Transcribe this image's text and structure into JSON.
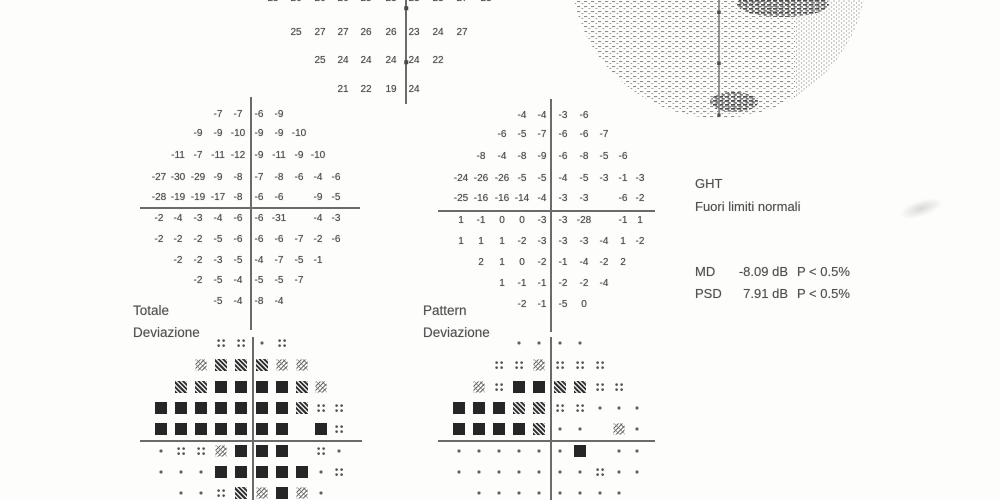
{
  "labels": {
    "total_plot_line1": "Totale",
    "total_plot_line2": "Deviazione",
    "pattern_plot_line1": "Pattern",
    "pattern_plot_line2": "Deviazione"
  },
  "summary": {
    "ght_title": "GHT",
    "ght_result": "Fuori limiti normali",
    "md_label": "MD",
    "md_value": "-8.09 dB",
    "md_p": "P < 0.5%",
    "psd_label": "PSD",
    "psd_value": "7.91 dB",
    "psd_p": "P < 0.5%"
  },
  "grids": [
    {
      "name": "threshold-grid",
      "kind": "numeric",
      "cols": [
        273,
        296,
        320,
        343,
        366,
        391,
        414,
        438,
        462,
        486
      ],
      "rows_y": [
        -1,
        33,
        61,
        90
      ],
      "rows": [
        [
          "25",
          "26",
          "26",
          "26",
          "25",
          "23",
          "23",
          "23",
          "27",
          "23"
        ],
        [
          "",
          "25",
          "27",
          "27",
          "26",
          "26",
          "23",
          "24",
          "27",
          ""
        ],
        [
          "",
          "",
          "25",
          "24",
          "24",
          "24",
          "24",
          "22",
          "",
          ""
        ],
        [
          "",
          "",
          "",
          "21",
          "22",
          "19",
          "24",
          "",
          "",
          ""
        ]
      ]
    },
    {
      "name": "total-deviation-grid",
      "kind": "numeric",
      "cols": [
        159,
        178,
        198,
        218,
        238,
        259,
        279,
        299,
        318,
        336
      ],
      "rows_y": [
        115,
        134,
        156,
        178,
        198,
        219,
        240,
        261,
        281,
        302
      ],
      "rows": [
        [
          "",
          "",
          "",
          "-7",
          "-7",
          "-6",
          "-9",
          "",
          "",
          ""
        ],
        [
          "",
          "",
          "-9",
          "-9",
          "-10",
          "-9",
          "-9",
          "-10",
          "",
          ""
        ],
        [
          "",
          "-11",
          "-7",
          "-11",
          "-12",
          "-9",
          "-11",
          "-9",
          "-10",
          ""
        ],
        [
          "-27",
          "-30",
          "-29",
          "-9",
          "-8",
          "-7",
          "-8",
          "-6",
          "-4",
          "-6"
        ],
        [
          "-28",
          "-19",
          "-19",
          "-17",
          "-8",
          "-6",
          "-6",
          "",
          "-9",
          "-5"
        ],
        [
          "-2",
          "-4",
          "-3",
          "-4",
          "-6",
          "-6",
          "-31",
          "",
          "-4",
          "-3"
        ],
        [
          "-2",
          "-2",
          "-2",
          "-5",
          "-6",
          "-6",
          "-6",
          "-7",
          "-2",
          "-6"
        ],
        [
          "",
          "-2",
          "-2",
          "-3",
          "-5",
          "-4",
          "-7",
          "-5",
          "-1",
          ""
        ],
        [
          "",
          "",
          "-2",
          "-5",
          "-4",
          "-5",
          "-5",
          "-7",
          "",
          ""
        ],
        [
          "",
          "",
          "",
          "-5",
          "-4",
          "-8",
          "-4",
          "",
          "",
          ""
        ]
      ]
    },
    {
      "name": "pattern-deviation-grid",
      "kind": "numeric",
      "cols": [
        461,
        481,
        502,
        522,
        542,
        563,
        584,
        604,
        623,
        640
      ],
      "rows_y": [
        116,
        135,
        157,
        179,
        199,
        221,
        242,
        263,
        284,
        305
      ],
      "rows": [
        [
          "",
          "",
          "",
          "-4",
          "-4",
          "-3",
          "-6",
          "",
          "",
          ""
        ],
        [
          "",
          "",
          "-6",
          "-5",
          "-7",
          "-6",
          "-6",
          "-7",
          "",
          ""
        ],
        [
          "",
          "-8",
          "-4",
          "-8",
          "-9",
          "-6",
          "-8",
          "-5",
          "-6",
          ""
        ],
        [
          "-24",
          "-26",
          "-26",
          "-5",
          "-5",
          "-4",
          "-5",
          "-3",
          "-1",
          "-3"
        ],
        [
          "-25",
          "-16",
          "-16",
          "-14",
          "-4",
          "-3",
          "-3",
          "",
          "-6",
          "-2"
        ],
        [
          "1",
          "-1",
          "0",
          "0",
          "-3",
          "-3",
          "-28",
          "",
          "-1",
          "1"
        ],
        [
          "1",
          "1",
          "1",
          "-2",
          "-3",
          "-3",
          "-3",
          "-4",
          "1",
          "-2"
        ],
        [
          "",
          "2",
          "1",
          "0",
          "-2",
          "-1",
          "-4",
          "-2",
          "2",
          ""
        ],
        [
          "",
          "",
          "1",
          "-1",
          "-1",
          "-2",
          "-2",
          "-4",
          "",
          ""
        ],
        [
          "",
          "",
          "",
          "-2",
          "-1",
          "-5",
          "0",
          "",
          "",
          ""
        ]
      ]
    },
    {
      "name": "total-deviation-probability-plot",
      "kind": "symbol",
      "cols": [
        161,
        181,
        201,
        221,
        241,
        262,
        282,
        302,
        321,
        339
      ],
      "rows_y": [
        343,
        365,
        387,
        408,
        429,
        451,
        472,
        493
      ],
      "rows": [
        [
          "",
          "",
          "",
          "p5",
          "p5",
          "dot",
          "p5",
          "",
          "",
          ""
        ],
        [
          "",
          "",
          "p2",
          "p1",
          "p1",
          "p1",
          "p2",
          "p2",
          "",
          ""
        ],
        [
          "",
          "p1",
          "p1",
          "p05",
          "p05",
          "p05",
          "p05",
          "p1",
          "p2",
          ""
        ],
        [
          "p05",
          "p05",
          "p05",
          "p05",
          "p05",
          "p05",
          "p05",
          "p1",
          "p5",
          "p5"
        ],
        [
          "p05",
          "p05",
          "p05",
          "p05",
          "p05",
          "p05",
          "p05",
          "",
          "p05",
          "p5"
        ],
        [
          "dot",
          "p5",
          "p5",
          "p2",
          "p05",
          "p05",
          "p05",
          "",
          "p5",
          "dot"
        ],
        [
          "dot",
          "dot",
          "dot",
          "p05",
          "p05",
          "p05",
          "p05",
          "p05",
          "dot",
          "p5"
        ],
        [
          "",
          "dot",
          "dot",
          "p5",
          "p1",
          "p2",
          "p05",
          "p2",
          "dot",
          ""
        ]
      ]
    },
    {
      "name": "pattern-deviation-probability-plot",
      "kind": "symbol",
      "cols": [
        459,
        479,
        499,
        519,
        539,
        560,
        580,
        600,
        619,
        637
      ],
      "rows_y": [
        343,
        365,
        387,
        408,
        429,
        451,
        472,
        493
      ],
      "rows": [
        [
          "",
          "",
          "",
          "dot",
          "dot",
          "dot",
          "dot",
          "",
          "",
          ""
        ],
        [
          "",
          "",
          "p5",
          "p5",
          "p2",
          "p5",
          "p5",
          "p5",
          "",
          ""
        ],
        [
          "",
          "p2",
          "p5",
          "p05",
          "p05",
          "p1",
          "p1",
          "p5",
          "p5",
          ""
        ],
        [
          "p05",
          "p05",
          "p05",
          "p1",
          "p1",
          "p5",
          "p5",
          "dot",
          "dot",
          "dot"
        ],
        [
          "p05",
          "p05",
          "p05",
          "p05",
          "p1",
          "dot",
          "dot",
          "",
          "p2",
          "dot"
        ],
        [
          "dot",
          "dot",
          "dot",
          "dot",
          "dot",
          "dot",
          "p05",
          "",
          "dot",
          "dot"
        ],
        [
          "dot",
          "dot",
          "dot",
          "dot",
          "dot",
          "dot",
          "dot",
          "p5",
          "dot",
          "dot"
        ],
        [
          "",
          "dot",
          "dot",
          "dot",
          "dot",
          "dot",
          "dot",
          "dot",
          "dot",
          ""
        ]
      ]
    }
  ],
  "lines": [
    {
      "name": "threshold-axis-vertical",
      "x": 405,
      "y": 0,
      "w": 1.6,
      "h": 104
    },
    {
      "name": "total-deviation-axis-vertical",
      "x": 250,
      "y": 97,
      "w": 1.6,
      "h": 233
    },
    {
      "name": "total-deviation-axis-horizontal",
      "x": 140,
      "y": 207,
      "w": 220,
      "h": 2
    },
    {
      "name": "pattern-deviation-axis-vertical",
      "x": 550,
      "y": 99,
      "w": 1.6,
      "h": 233
    },
    {
      "name": "pattern-deviation-axis-horizontal",
      "x": 438,
      "y": 210,
      "w": 217,
      "h": 2
    },
    {
      "name": "total-probability-axis-vertical",
      "x": 252,
      "y": 337,
      "w": 1.6,
      "h": 163
    },
    {
      "name": "total-probability-axis-horizontal",
      "x": 140,
      "y": 440,
      "w": 222,
      "h": 2
    },
    {
      "name": "pattern-probability-axis-vertical",
      "x": 550,
      "y": 337,
      "w": 1.6,
      "h": 163
    },
    {
      "name": "pattern-probability-axis-horizontal",
      "x": 438,
      "y": 440,
      "w": 217,
      "h": 2
    }
  ],
  "ticks": [
    {
      "x": 406,
      "y": 8
    },
    {
      "x": 406,
      "y": 62
    }
  ]
}
